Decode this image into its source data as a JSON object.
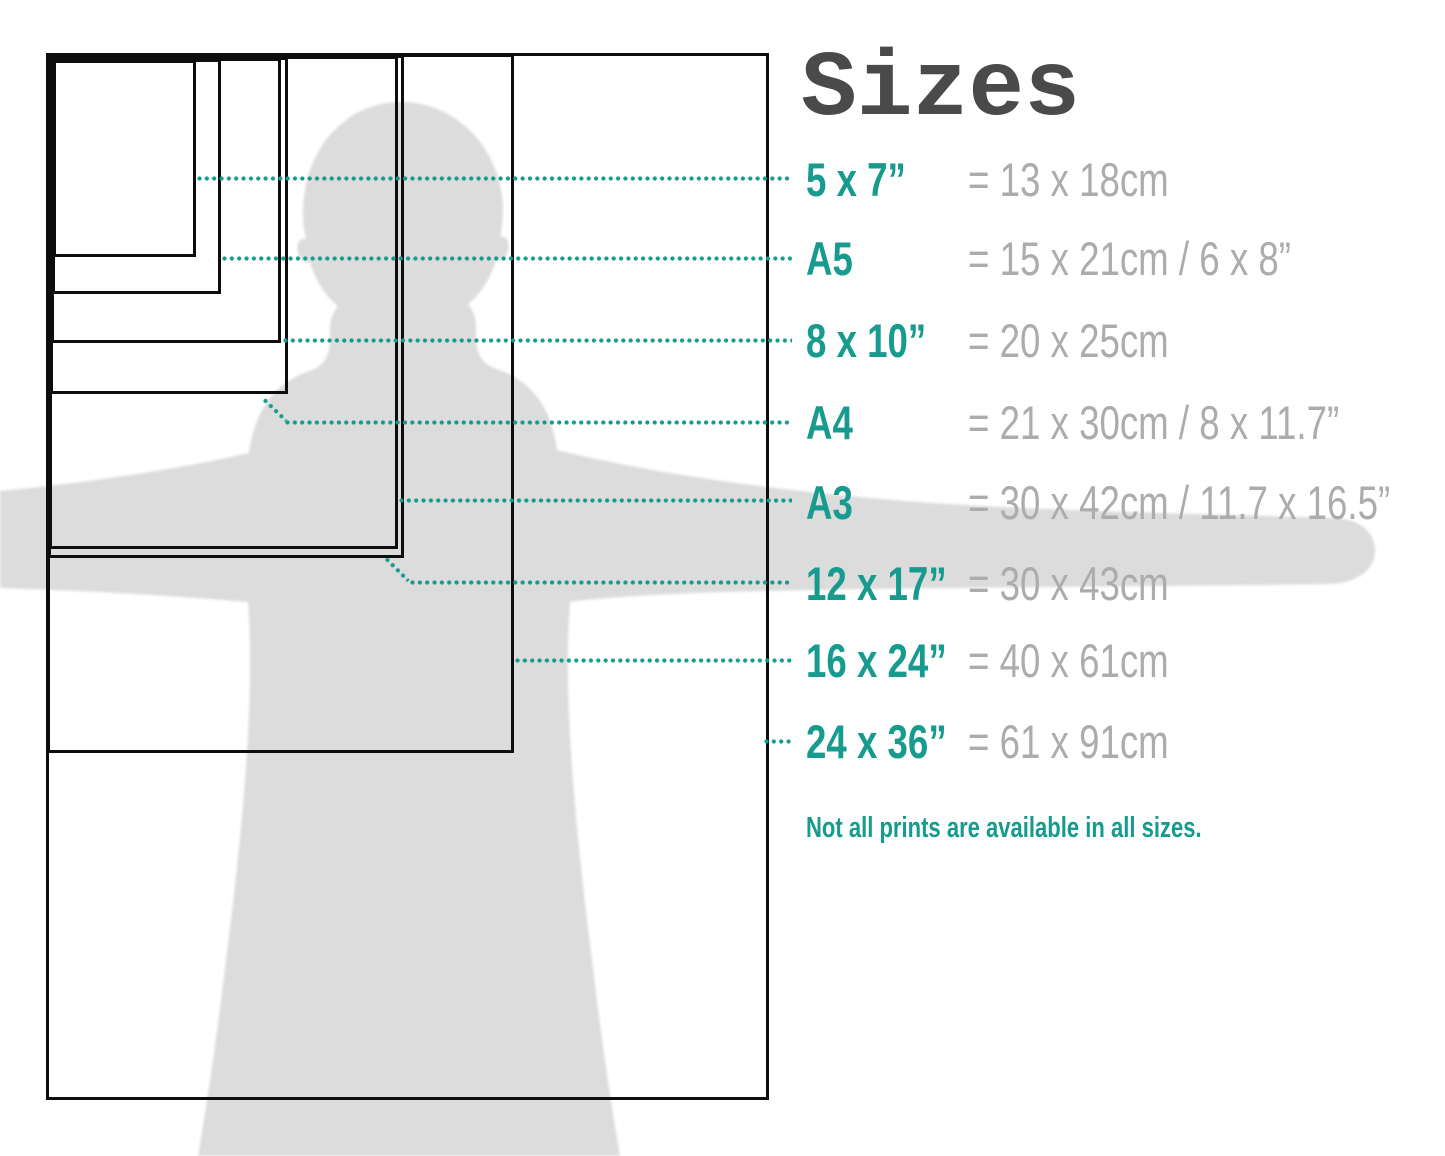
{
  "title": "Sizes",
  "note": "Not all prints are available in all sizes.",
  "colors": {
    "teal": "#179B8E",
    "text_gray": "#ACACAC",
    "title_gray": "#4A4A4A",
    "silhouette_gray": "#DCDCDC",
    "line_black": "#0D0D0D"
  },
  "sizes": [
    {
      "id": "5x7",
      "label": "5 x 7”",
      "metric": "= 13 x 18cm"
    },
    {
      "id": "a5",
      "label": "A5",
      "metric": "= 15 x 21cm / 6 x 8”"
    },
    {
      "id": "8x10",
      "label": "8 x 10”",
      "metric": "= 20 x 25cm"
    },
    {
      "id": "a4",
      "label": "A4",
      "metric": "= 21 x 30cm / 8 x 11.7”"
    },
    {
      "id": "a3",
      "label": "A3",
      "metric": "= 30 x 42cm / 11.7 x 16.5”"
    },
    {
      "id": "12x17",
      "label": "12 x 17”",
      "metric": "= 30 x 43cm"
    },
    {
      "id": "16x24",
      "label": "16 x 24”",
      "metric": "= 40 x 61cm"
    },
    {
      "id": "24x36",
      "label": "24 x 36”",
      "metric": "= 61 x 91cm"
    }
  ]
}
